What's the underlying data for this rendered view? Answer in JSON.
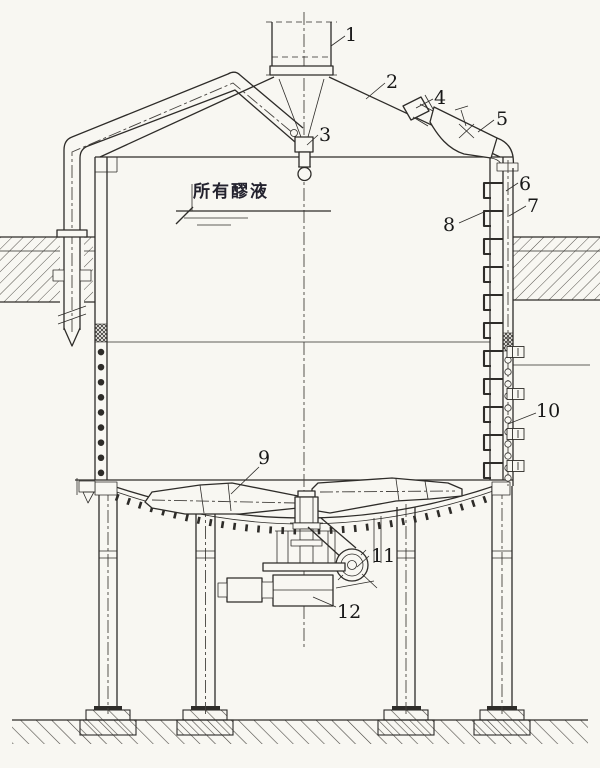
{
  "figure": {
    "annotation": "所有醪液",
    "labels": [
      "1",
      "2",
      "3",
      "4",
      "5",
      "6",
      "7",
      "8",
      "9",
      "10",
      "11",
      "12"
    ]
  },
  "colors": {
    "ink": "#2e2c29",
    "paper": "#f8f7f2"
  }
}
